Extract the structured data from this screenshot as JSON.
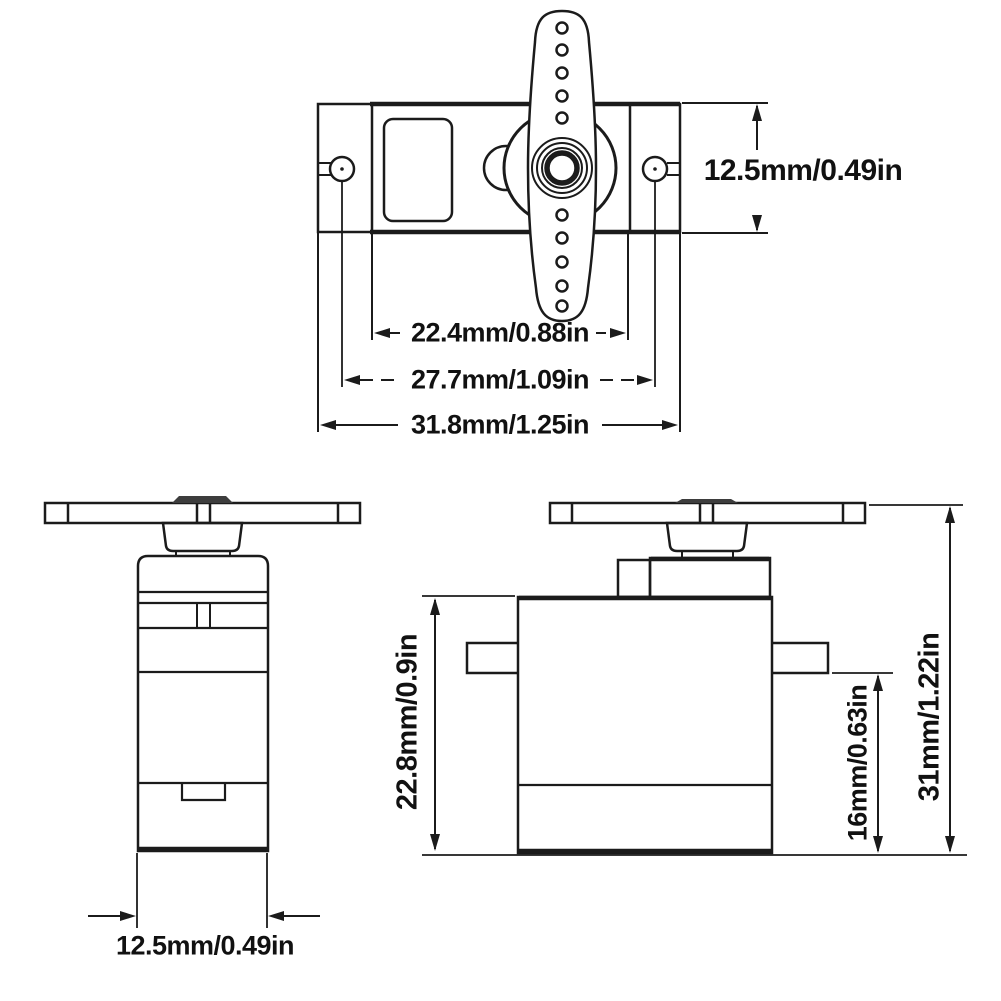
{
  "title": "Micro servo dimension drawing",
  "colors": {
    "line": "#1b1b1b",
    "background": "#ffffff",
    "text": "#111111",
    "shaft_cap_fill": "#3d3d3d"
  },
  "views": {
    "top": {
      "plate_height_label": "12.5mm/0.49in",
      "body_width_label": "22.4mm/0.88in",
      "mount_hole_span_label": "27.7mm/1.09in",
      "plate_width_label": "31.8mm/1.25in"
    },
    "front": {
      "body_depth_label": "12.5mm/0.49in"
    },
    "side": {
      "body_height_label": "22.8mm/0.9in",
      "bottom_to_flange_label": "16mm/0.63in",
      "total_height_label": "31mm/1.22in"
    }
  }
}
